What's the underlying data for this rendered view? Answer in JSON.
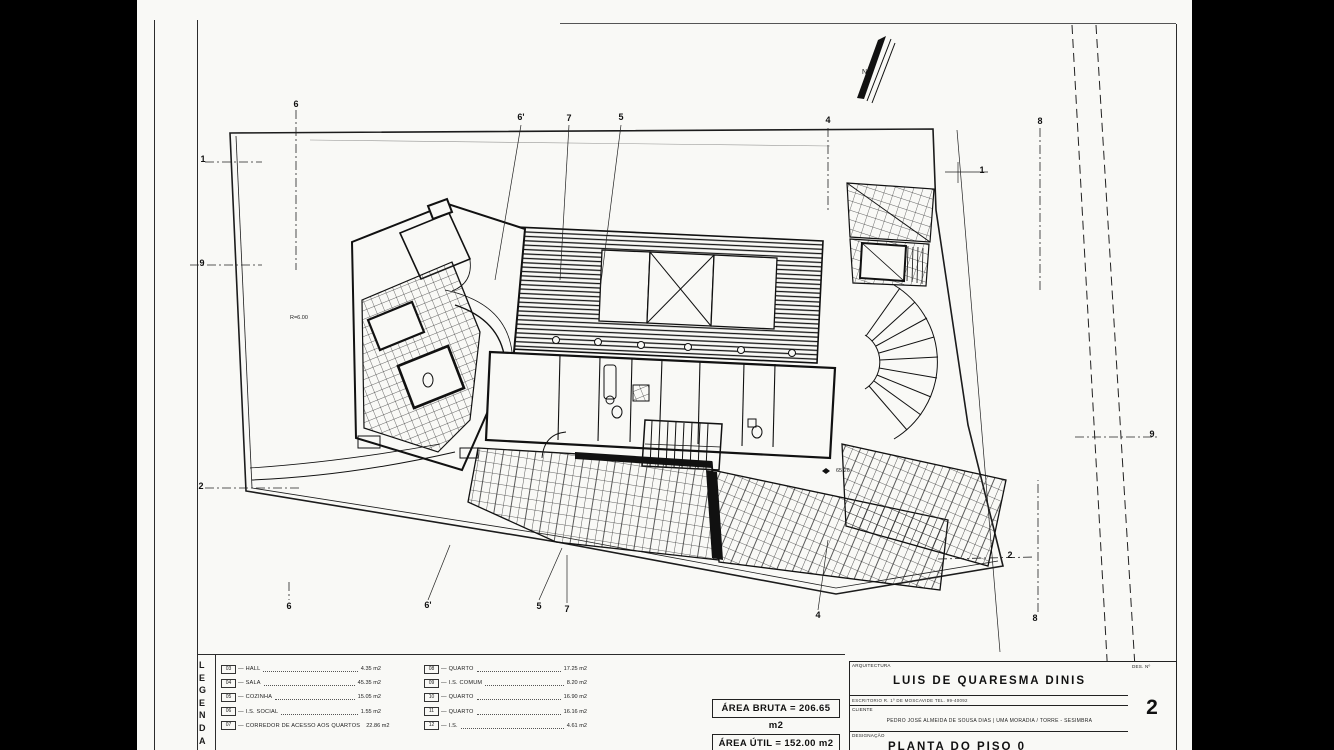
{
  "legend": {
    "title_letters": [
      "L",
      "E",
      "G",
      "E",
      "N",
      "D",
      "A"
    ],
    "items_left": [
      {
        "num": "03",
        "label": "HALL",
        "value": "4.35 m2"
      },
      {
        "num": "04",
        "label": "SALA",
        "value": "45.35 m2"
      },
      {
        "num": "05",
        "label": "COZINHA",
        "value": "15.05 m2"
      },
      {
        "num": "06",
        "label": "I.S. SOCIAL",
        "value": "1.55 m2"
      },
      {
        "num": "07",
        "label": "CORREDOR DE ACESSO AOS QUARTOS",
        "value": "22.86 m2"
      }
    ],
    "items_right": [
      {
        "num": "08",
        "label": "QUARTO",
        "value": "17.25 m2"
      },
      {
        "num": "09",
        "label": "I.S. COMUM",
        "value": "8.20 m2"
      },
      {
        "num": "10",
        "label": "QUARTO",
        "value": "16.90 m2"
      },
      {
        "num": "11",
        "label": "QUARTO",
        "value": "16.16 m2"
      },
      {
        "num": "12",
        "label": "I.S.",
        "value": "4.61 m2"
      }
    ]
  },
  "areas": {
    "bruta": "ÁREA BRUTA = 206.65 m2",
    "util": "ÁREA ÚTIL = 152.00 m2"
  },
  "title_block": {
    "arquitectura_label": "ARQUITECTURA",
    "architect": "LUIS DE QUARESMA DINIS",
    "escritorio_line": "ESCRITORIO   R. 1º DE  MOSCAVIDE   TEL. 99-40092",
    "cliente_label": "CLIENTE",
    "cliente": "PEDRO JOSÉ ALMEIDA DE SOUSA DIAS | UMA MORADIA / TORRE - SESIMBRA",
    "designacao_label": "DESIGNAÇÃO",
    "designacao": "PLANTA DO PISO 0",
    "des_no_label": "DES. Nº",
    "des_no": "2"
  },
  "plan": {
    "north_label": "N",
    "markers": [
      {
        "label": "6",
        "x": 296,
        "y": 104
      },
      {
        "label": "6'",
        "x": 521,
        "y": 117
      },
      {
        "label": "7",
        "x": 569,
        "y": 118
      },
      {
        "label": "5",
        "x": 621,
        "y": 117
      },
      {
        "label": "4",
        "x": 828,
        "y": 120
      },
      {
        "label": "8",
        "x": 1040,
        "y": 121
      },
      {
        "label": "1",
        "x": 982,
        "y": 170
      },
      {
        "label": "1",
        "x": 203,
        "y": 159
      },
      {
        "label": "9",
        "x": 202,
        "y": 263
      },
      {
        "label": "2",
        "x": 201,
        "y": 486
      },
      {
        "label": "9",
        "x": 1152,
        "y": 434
      },
      {
        "label": "2",
        "x": 1010,
        "y": 555
      },
      {
        "label": "6",
        "x": 289,
        "y": 606
      },
      {
        "label": "6'",
        "x": 428,
        "y": 605
      },
      {
        "label": "5",
        "x": 539,
        "y": 606
      },
      {
        "label": "7",
        "x": 567,
        "y": 609
      },
      {
        "label": "4",
        "x": 818,
        "y": 615
      },
      {
        "label": "8",
        "x": 1035,
        "y": 618
      }
    ],
    "annotations": [
      {
        "text": "R=6.00",
        "x": 290,
        "y": 315
      },
      {
        "text": "65.26",
        "x": 836,
        "y": 468
      }
    ]
  }
}
